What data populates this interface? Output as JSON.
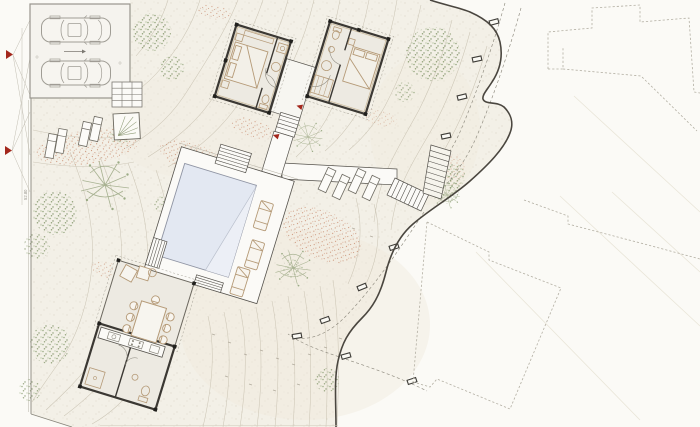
{
  "page": {
    "title": "Villa site plan drawing"
  },
  "labels": {
    "dimension_left": "52.80"
  },
  "colors": {
    "paper": "#fbfaf6",
    "terrain": "#f3f0e7",
    "contour": "#c6bfae",
    "boundary": "#4a463f",
    "water": "#e3e8f2",
    "water_light": "#eceff6",
    "deck": "#fbfaf7",
    "floor": "#edeae2",
    "wall": "#3b3833",
    "furniture_tan": "#b59a77",
    "vegetation_green": "#8da076",
    "vegetation_red": "#c98b6d",
    "neighbor_dash": "#b3afa3",
    "accent_red": "#a3271c",
    "car_gray": "#a09d95"
  },
  "inventory": {
    "cars": 2,
    "bedroom_pavilions": 2,
    "pools": 1,
    "pool_loungers": 3,
    "lawn_loungers": 4,
    "terrace_loungers": 4,
    "dining_chairs": 8,
    "stepping_stones": 10,
    "neighbor_buildings": 3,
    "section_markers": 2,
    "entry_arrows": 2,
    "planters": 1
  }
}
